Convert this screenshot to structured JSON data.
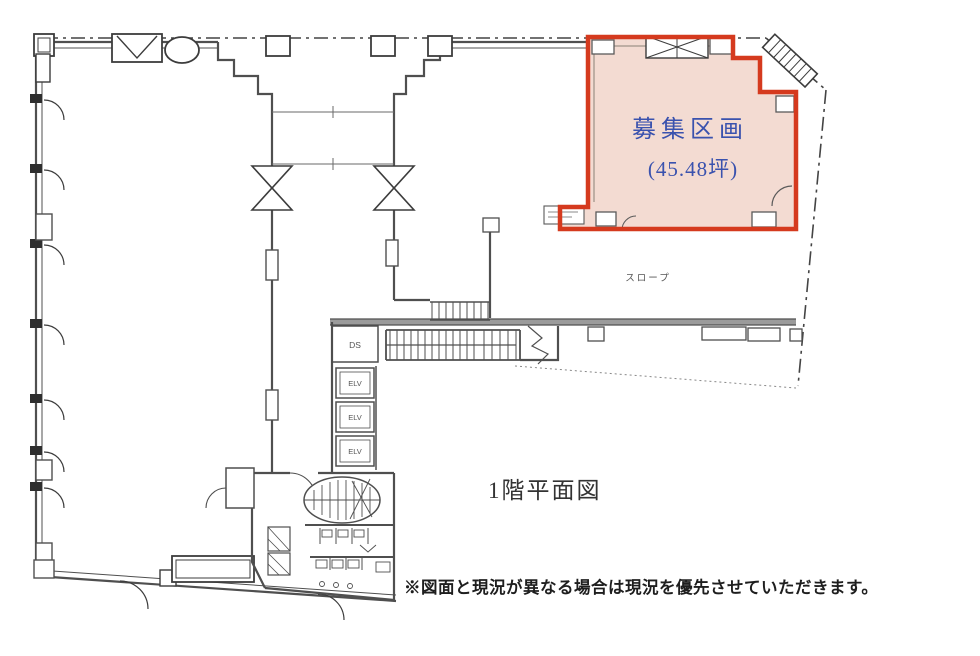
{
  "floorplan": {
    "title": "1階平面図",
    "disclaimer": "※図面と現況が異なる場合は現況を優先させていただきます。",
    "highlight": {
      "name": "募集区画",
      "area": "(45.48坪)",
      "fill": "#f3dbd2",
      "border": "#d53a1e",
      "text_color": "#3a52ae"
    },
    "labels": {
      "slope": "スロープ",
      "ds": "DS",
      "elevators": [
        "ELV",
        "ELV",
        "ELV"
      ]
    },
    "colors": {
      "wall": "#4f4f4f",
      "wall_light": "#9b9b9b",
      "boundary": "#444444",
      "detail": "#6a6a6a",
      "title_color": "#333333",
      "disclaimer_color": "#1e1e1e"
    }
  }
}
